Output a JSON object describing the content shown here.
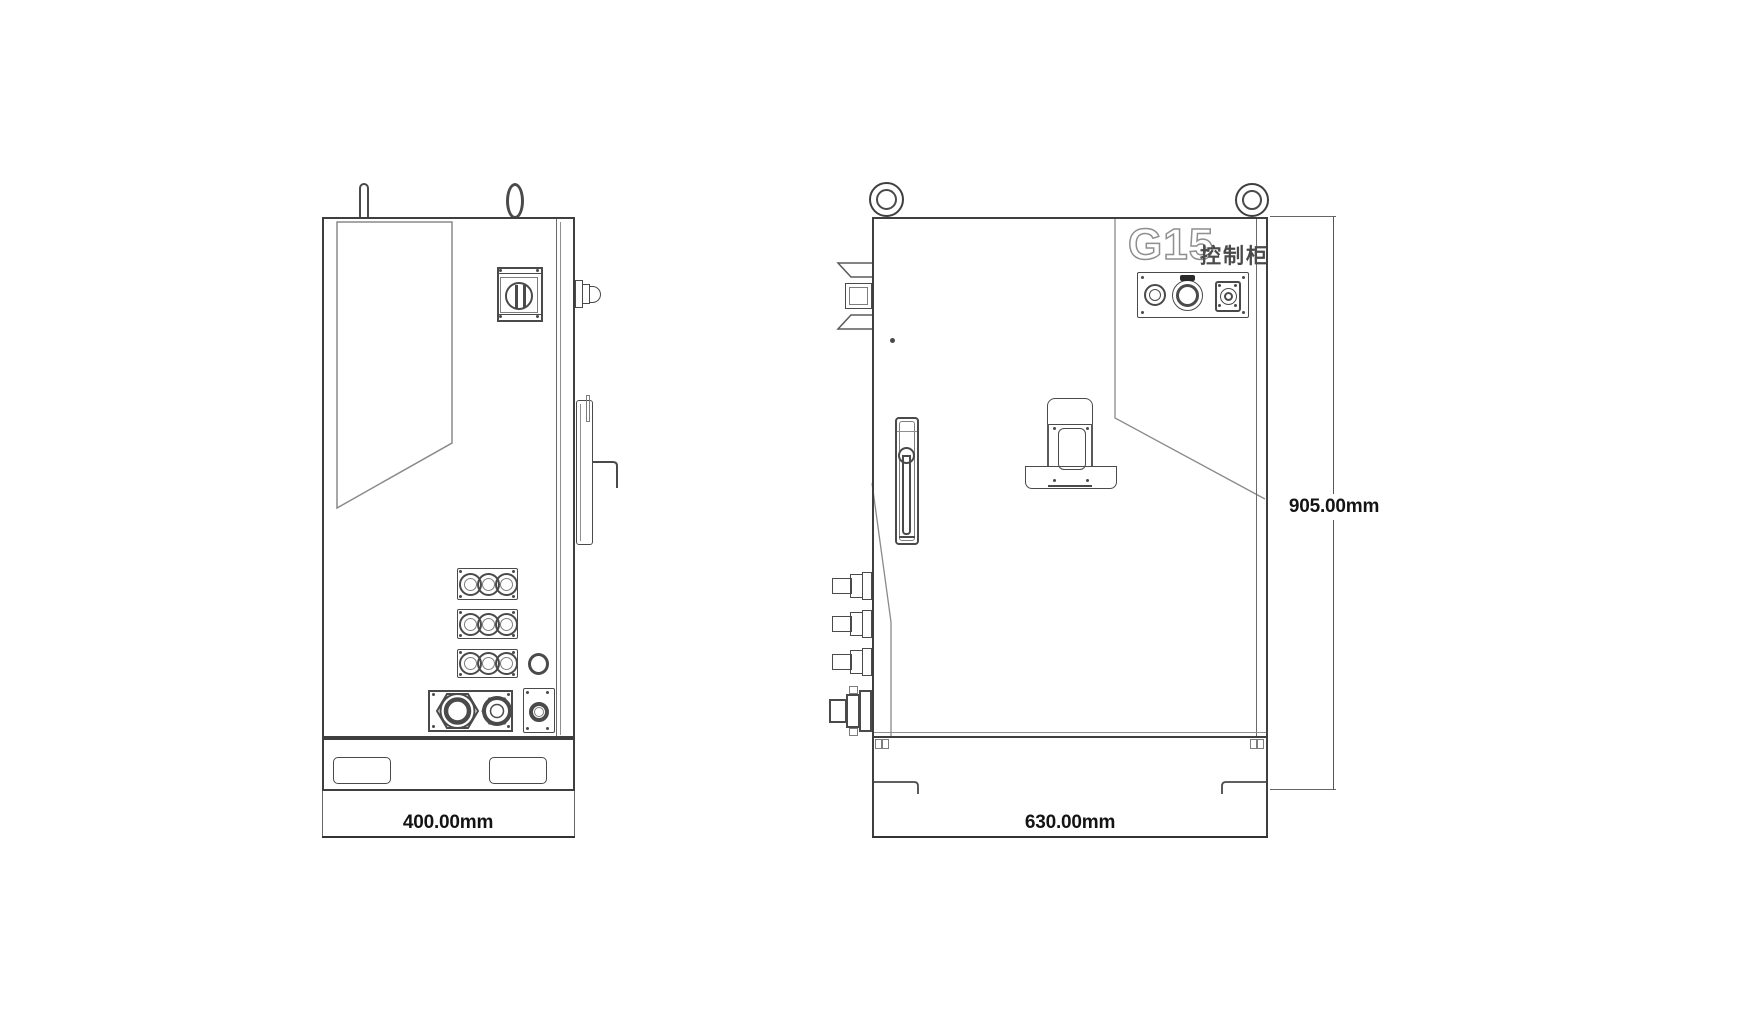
{
  "side_view": {
    "dimension_width": "400.00mm"
  },
  "front_view": {
    "model": "G15",
    "model_caption": "控制柜",
    "dimension_width": "630.00mm",
    "dimension_height": "905.00mm"
  },
  "colors": {
    "background": "#ffffff",
    "line": "#4a4a4a",
    "line_light": "#8f8f8f",
    "dimension_text": "#141414"
  }
}
